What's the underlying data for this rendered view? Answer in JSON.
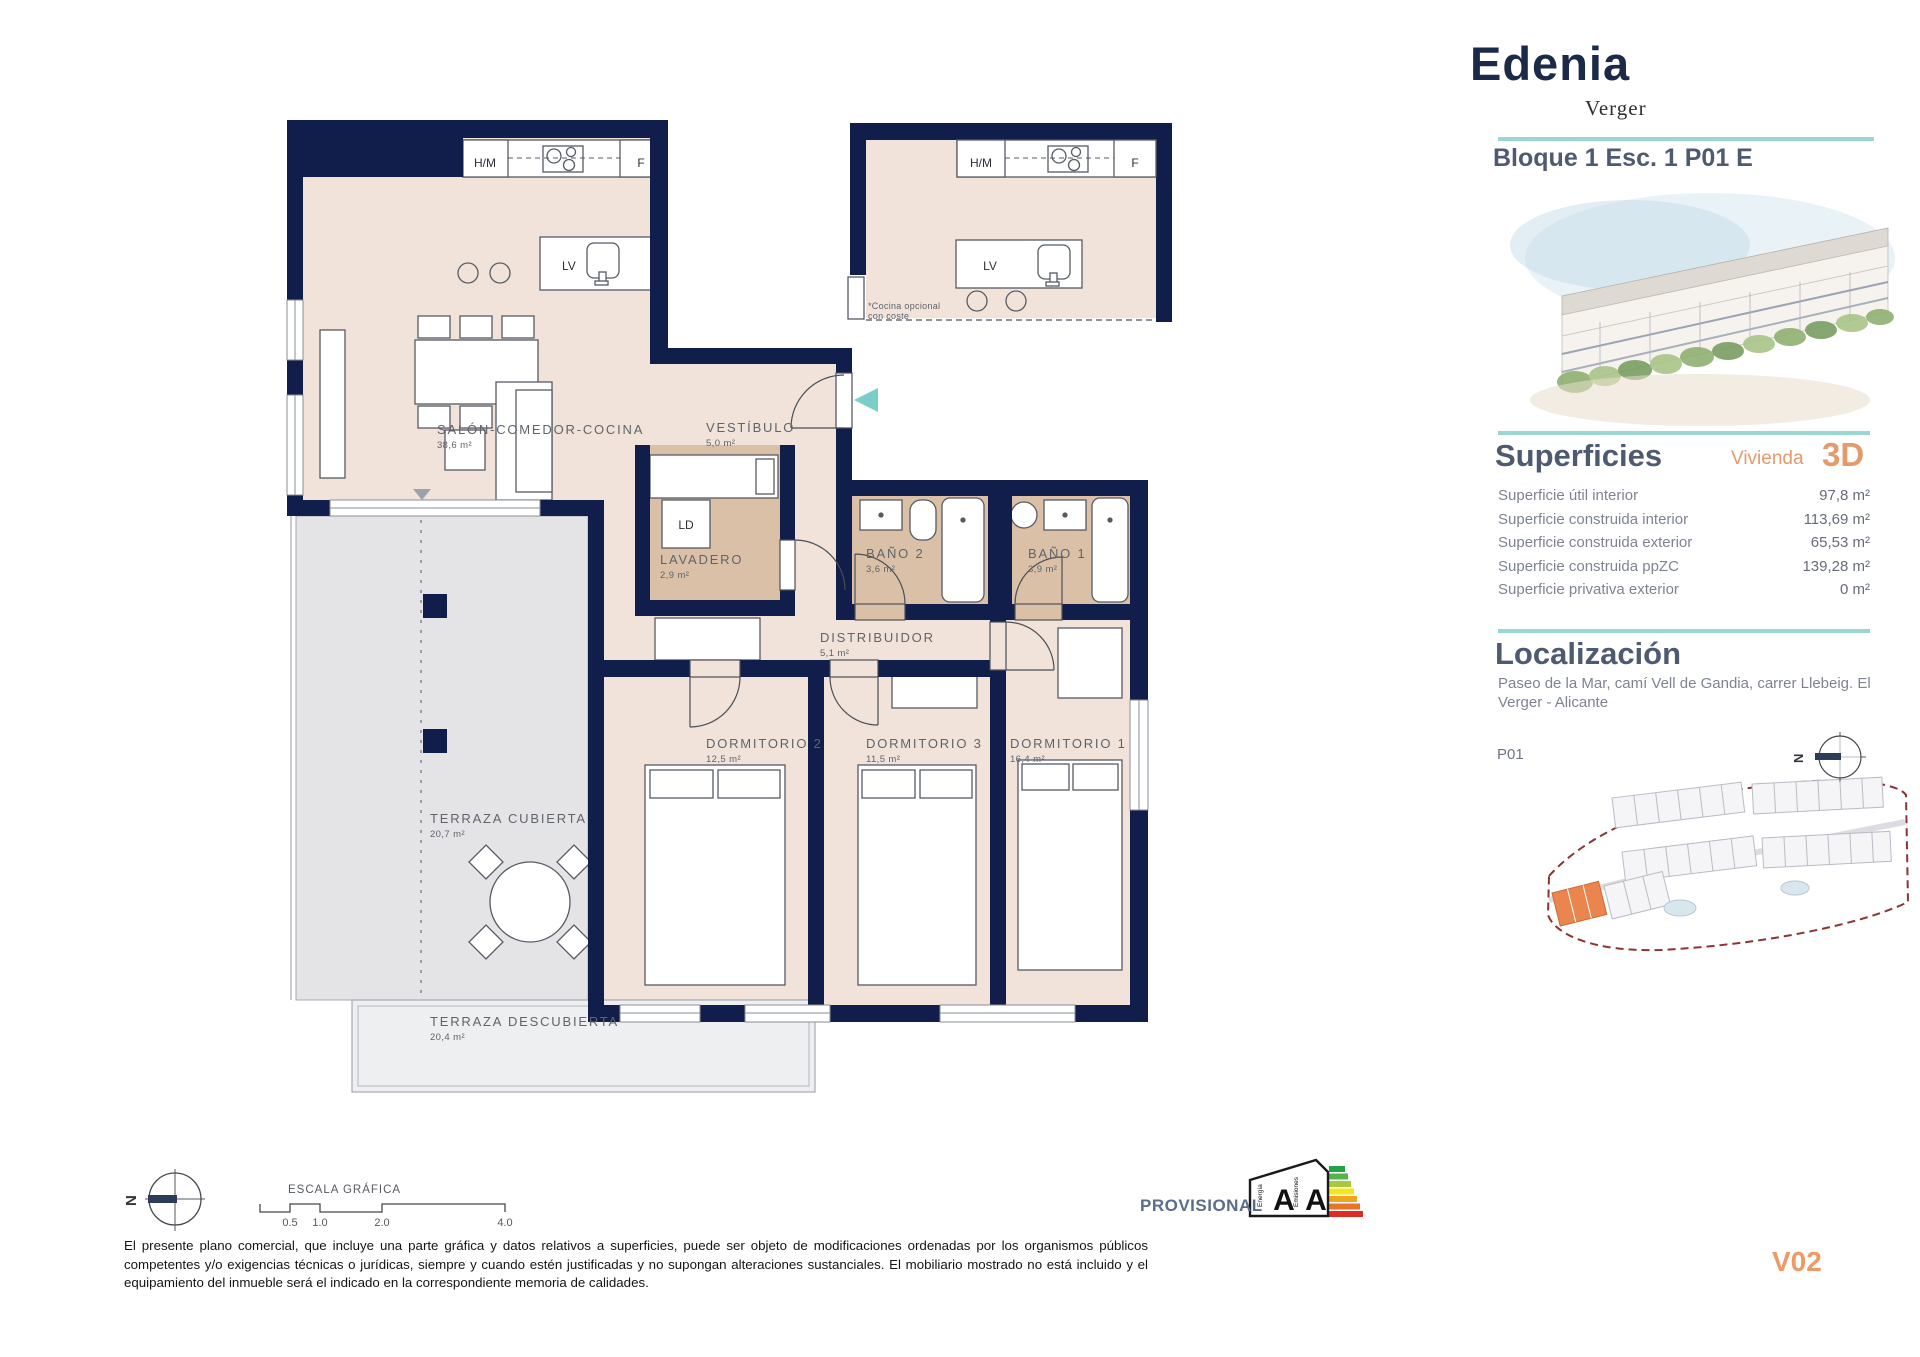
{
  "header": {
    "brand": "Edenia",
    "brand_sub": "Verger",
    "unit_title": "Bloque 1 Esc. 1 P01 E"
  },
  "superficies": {
    "title": "Superficies",
    "subtitle": "Vivienda",
    "type_code": "3D",
    "rows": [
      {
        "label": "Superficie útil interior",
        "value": "97,8 m²"
      },
      {
        "label": "Superficie construida interior",
        "value": "113,69 m²"
      },
      {
        "label": "Superficie construida exterior",
        "value": "65,53 m²"
      },
      {
        "label": "Superficie construida ppZC",
        "value": "139,28 m²"
      },
      {
        "label": "Superficie privativa exterior",
        "value": "0 m²"
      }
    ]
  },
  "localizacion": {
    "title": "Localización",
    "address": "Paseo de la Mar, camí Vell de Gandia, carrer Llebeig. El Verger - Alicante",
    "floor_label": "P01"
  },
  "compass": {
    "north": "N"
  },
  "plan": {
    "rooms": {
      "salon": {
        "name": "SALÓN-COMEDOR-COCINA",
        "area": "38,6 m²"
      },
      "vestibulo": {
        "name": "VESTÍBULO",
        "area": "5,0 m²"
      },
      "lavadero": {
        "name": "LAVADERO",
        "area": "2,9 m²"
      },
      "bano2": {
        "name": "BAÑO 2",
        "area": "3,6 m²"
      },
      "bano1": {
        "name": "BAÑO 1",
        "area": "3,9 m²"
      },
      "distribuidor": {
        "name": "DISTRIBUIDOR",
        "area": "5,1 m²"
      },
      "dorm2": {
        "name": "DORMITORIO 2",
        "area": "12,5 m²"
      },
      "dorm3": {
        "name": "DORMITORIO 3",
        "area": "11,5 m²"
      },
      "dorm1": {
        "name": "DORMITORIO 1",
        "area": "16,4 m²"
      },
      "terraza_cubierta": {
        "name": "TERRAZA CUBIERTA",
        "area": "20,7 m²"
      },
      "terraza_descubierta": {
        "name": "TERRAZA DESCUBIERTA",
        "area": "20,4 m²"
      }
    },
    "appliances": {
      "hm": "H/M",
      "f": "F",
      "lv": "LV",
      "ld": "LD"
    },
    "kitchen_note_line1": "*Cocina opcional",
    "kitchen_note_line2": "con coste"
  },
  "scale_bar": {
    "title": "ESCALA GRÁFICA",
    "ticks": [
      "0.5",
      "1.0",
      "2.0",
      "4.0"
    ]
  },
  "energy": {
    "status": "PROVISIONAL",
    "rating_energy": "A",
    "rating_emissions": "A",
    "axis_energy": "Energía",
    "axis_emissions": "Emisiones"
  },
  "footer": {
    "version": "V02",
    "disclaimer": "El presente plano comercial, que incluye una parte gráfica y datos relativos a superficies, puede ser objeto de modificaciones ordenadas por los organismos públicos competentes y/o exigencias técnicas o jurídicas, siempre y cuando estén justificadas y no supongan alteraciones sustanciales. El mobiliario mostrado no está incluido y el equipamiento del inmueble será el indicado en la correspondiente memoria de calidades."
  },
  "colors": {
    "wall_navy": "#111d4a",
    "floor_beige": "#f1e3da",
    "wet_room_tan": "#dbc0a8",
    "terrace_grey": "#e4e4e7",
    "accent_teal": "#9bd7d1",
    "accent_orange": "#ee9a67",
    "brand_navy": "#1c2a4a",
    "heading_slate": "#4d5a70",
    "site_boundary_red": "#8c3434"
  }
}
